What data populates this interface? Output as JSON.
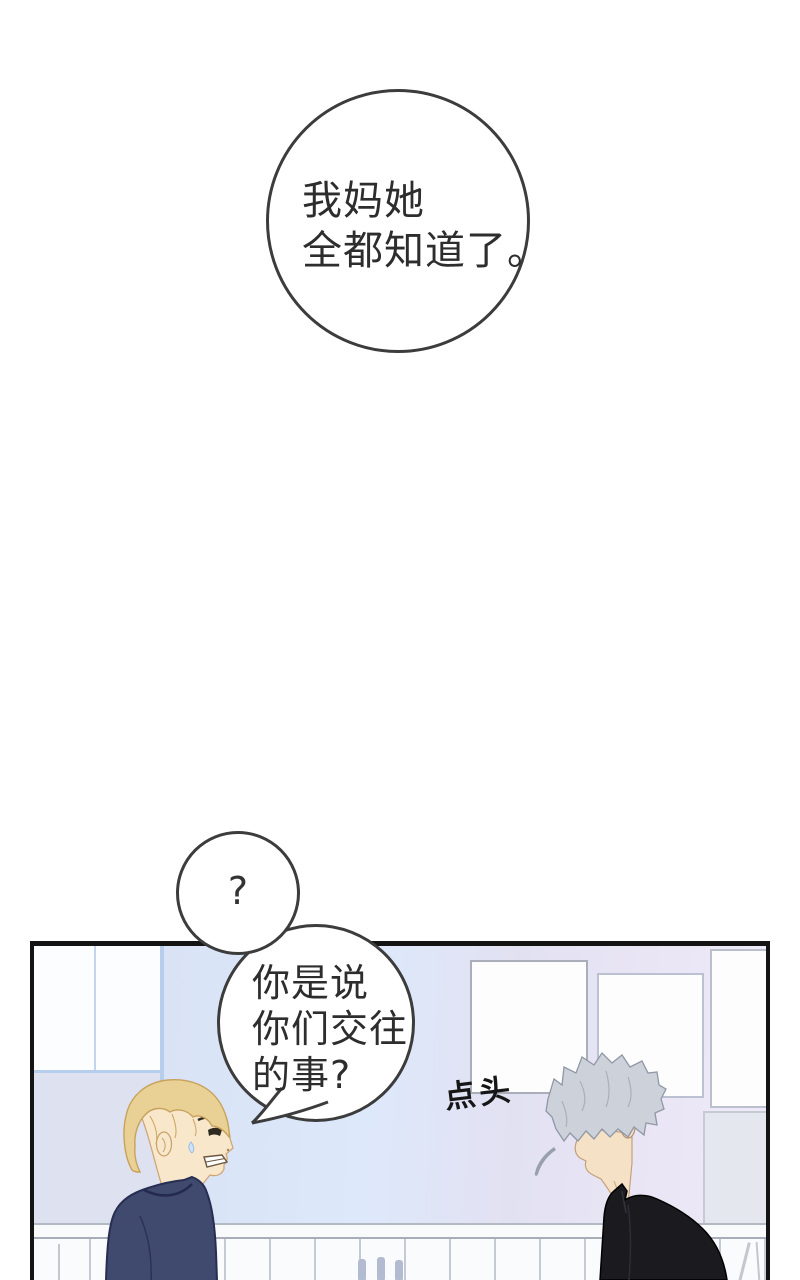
{
  "page": {
    "kind": "webtoon-comic-panel",
    "background": "#ffffff"
  },
  "speech": {
    "top_bubble": {
      "lines": [
        "我妈她",
        "全都知道了。"
      ]
    },
    "question_bubble": {
      "text": "?"
    },
    "reply_bubble": {
      "lines": [
        "你是说",
        "你们交往",
        "的事?"
      ]
    }
  },
  "sfx": {
    "nod": "点头"
  },
  "scene": {
    "characters": [
      {
        "name": "blond-student",
        "hair_color": "#e9d094",
        "shirt_color": "#404a6e",
        "facing": "right"
      },
      {
        "name": "silver-haired-student",
        "hair_color": "#cdd1da",
        "shirt_color": "#1a1a1f",
        "facing": "left"
      }
    ],
    "background_objects": [
      "window",
      "posters",
      "whiteboard-rail",
      "marker-pens",
      "easel-legs"
    ]
  },
  "colors": {
    "bubble_border": "#3c3c3c",
    "panel_border": "#141414",
    "wall_blue": "#d9e4f7",
    "wall_lavender": "#e9e5f5",
    "window_frame": "#b7cdec",
    "text": "#2d2d2d"
  }
}
